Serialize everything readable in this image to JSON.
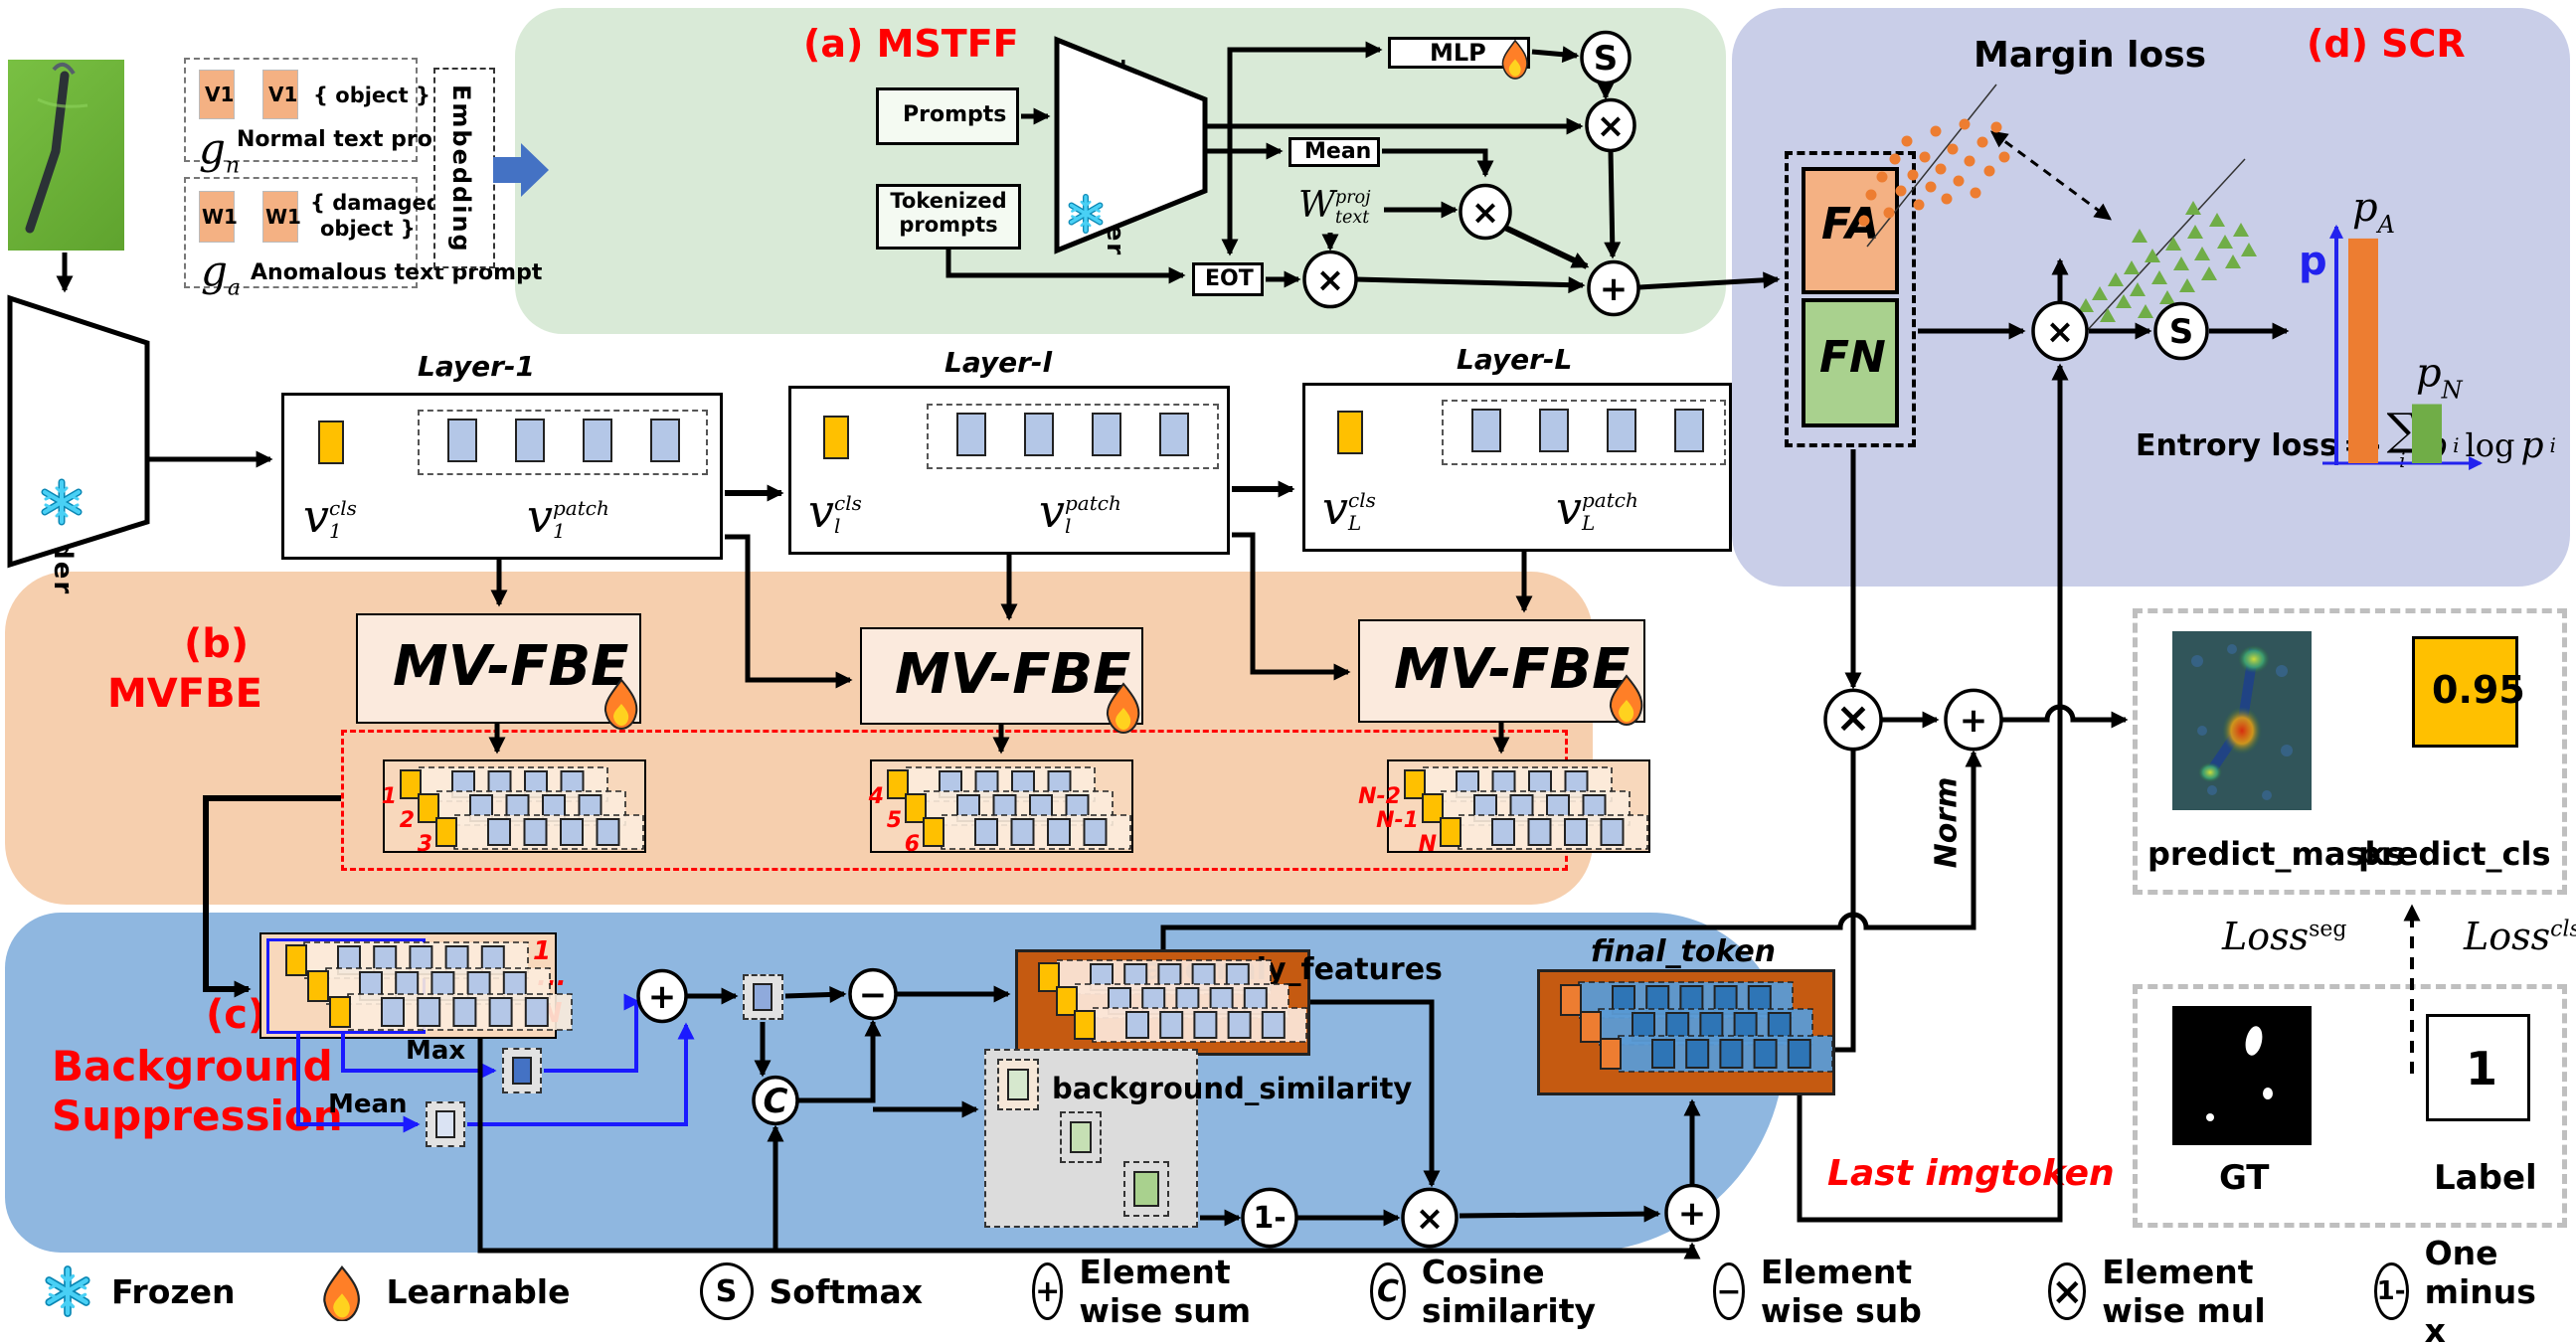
{
  "regions": {
    "a": "(a) MSTFF",
    "b1": "(b)",
    "b2": "MVFBE",
    "c1": "(c)",
    "c2": "Background",
    "c3": "Suppression",
    "d": "(d) SCR"
  },
  "prompts": {
    "v1": "V1",
    "w1": "W1",
    "object": "{ object }",
    "damaged1": "{ damaged",
    "damaged2": "object }",
    "normal": "Normal text prompt",
    "anomalous": "Anomalous text prompt",
    "g": "g",
    "gn_sub": "n",
    "ga_sub": "a",
    "embedding": "Embedding"
  },
  "encoders": {
    "image": "Image Encoder",
    "text": "Text Encoder"
  },
  "mstff": {
    "prompts": "Prompts",
    "tokenized": "Tokenized prompts",
    "mlp": "MLP",
    "mean": "Mean",
    "eot": "EOT",
    "w_base": "W",
    "w_sub": "text",
    "w_sup": "proj"
  },
  "layers": [
    {
      "title": "Layer-1",
      "sub": "1"
    },
    {
      "title": "Layer-l",
      "sub": "l"
    },
    {
      "title": "Layer-L",
      "sub": "L"
    }
  ],
  "math": {
    "v": "v",
    "cls": "cls",
    "patch": "patch"
  },
  "mvfbe": {
    "box": "MV-FBE",
    "stack_labels": [
      [
        "1",
        "2",
        "3"
      ],
      [
        "4",
        "5",
        "6"
      ],
      [
        "N-2",
        "N-1",
        "N"
      ]
    ]
  },
  "bs": {
    "first": "1",
    "dots": "...",
    "last_n": "N",
    "max": "Max",
    "mean": "Mean",
    "anomaly": "anomaly_features",
    "background": "background_similarity",
    "final": "final_token",
    "norm": "Norm",
    "last_imgtoken": "Last imgtoken"
  },
  "scr": {
    "fa": "FA",
    "fn": "FN",
    "margin": "Margin loss",
    "entropy": {
      "prefix": "Entrory loss",
      "eq": "=-",
      "sum": "∑",
      "sum_sub": "i",
      "p": "p",
      "p_sub": "i",
      "log": "log"
    }
  },
  "outputs": {
    "predict_masks": "predict_masks",
    "predict_cls": "predict_cls",
    "score": "0.95",
    "gt": "GT",
    "label": "Label",
    "label_value": "1",
    "loss_seg_base": "Loss",
    "loss_seg_sup": "seg",
    "loss_cls_base": "Loss",
    "loss_cls_sup": "cls"
  },
  "ops": {
    "softmax": "S",
    "sum": "+",
    "mul": "×",
    "subtract": "−",
    "cos": "C",
    "one_minus": "1-"
  },
  "legend": [
    {
      "icon": "snowflake-icon",
      "label": "Frozen"
    },
    {
      "icon": "flame-icon",
      "label": "Learnable"
    },
    {
      "icon": "softmax-op-icon",
      "glyph": "S",
      "label": "Softmax"
    },
    {
      "icon": "sum-op-icon",
      "glyph": "+",
      "label": "Element wise sum"
    },
    {
      "icon": "cosine-op-icon",
      "glyph": "C",
      "label": "Cosine similarity"
    },
    {
      "icon": "sub-op-icon",
      "glyph": "−",
      "label": "Element wise sub"
    },
    {
      "icon": "mul-op-icon",
      "glyph": "×",
      "label": "Element wise mul"
    },
    {
      "icon": "one-minus-op-icon",
      "glyph": "1-",
      "label": "One minus x"
    }
  ],
  "chart_data": {
    "type": "bar",
    "categories": [
      "p_A",
      "p_N"
    ],
    "values": [
      0.95,
      0.25
    ],
    "bar_colors": [
      "#ed7d31",
      "#70ad47"
    ],
    "ylabel": "p",
    "ylim": [
      0,
      1
    ],
    "axis_color": "#2222ee",
    "grid": false,
    "legend_position": "none"
  },
  "clusters": {
    "orange_dots": [
      [
        1882,
        196
      ],
      [
        1893,
        178
      ],
      [
        1900,
        214
      ],
      [
        1906,
        160
      ],
      [
        1912,
        192
      ],
      [
        1918,
        142
      ],
      [
        1924,
        176
      ],
      [
        1930,
        206
      ],
      [
        1936,
        158
      ],
      [
        1942,
        188
      ],
      [
        1947,
        132
      ],
      [
        1952,
        170
      ],
      [
        1958,
        200
      ],
      [
        1964,
        150
      ],
      [
        1970,
        182
      ],
      [
        1976,
        125
      ],
      [
        1981,
        162
      ],
      [
        1987,
        194
      ],
      [
        1994,
        143
      ],
      [
        2001,
        172
      ],
      [
        2008,
        128
      ],
      [
        2016,
        158
      ],
      [
        1875,
        222
      ]
    ],
    "green_triangles": [
      [
        2098,
        308
      ],
      [
        2112,
        296
      ],
      [
        2120,
        318
      ],
      [
        2128,
        282
      ],
      [
        2136,
        304
      ],
      [
        2144,
        270
      ],
      [
        2150,
        292
      ],
      [
        2158,
        314
      ],
      [
        2165,
        258
      ],
      [
        2172,
        280
      ],
      [
        2180,
        300
      ],
      [
        2186,
        246
      ],
      [
        2194,
        266
      ],
      [
        2200,
        288
      ],
      [
        2208,
        234
      ],
      [
        2215,
        256
      ],
      [
        2222,
        276
      ],
      [
        2230,
        222
      ],
      [
        2238,
        244
      ],
      [
        2246,
        264
      ],
      [
        2254,
        232
      ],
      [
        2262,
        252
      ],
      [
        2152,
        238
      ],
      [
        2206,
        210
      ]
    ]
  },
  "colors": {
    "green_region": "#d9ead7",
    "purple_region": "#c9cee8",
    "peach_region": "#f6cfae",
    "blue_region": "#8fb7e0",
    "cls_token": "#ffc000",
    "patch_token": "#b4c7e7",
    "orange": "#ed7d31",
    "green": "#70ad47",
    "brown": "#c55a11",
    "mid_blue": "#5b9bd5",
    "dark_blue_token": "#2e75b6",
    "accent_red": "#ff0000",
    "axis_blue": "#2222ee",
    "fa": "#f4b183",
    "fn": "#a9d18e",
    "mvfbe_fill": "#fbeadd"
  }
}
